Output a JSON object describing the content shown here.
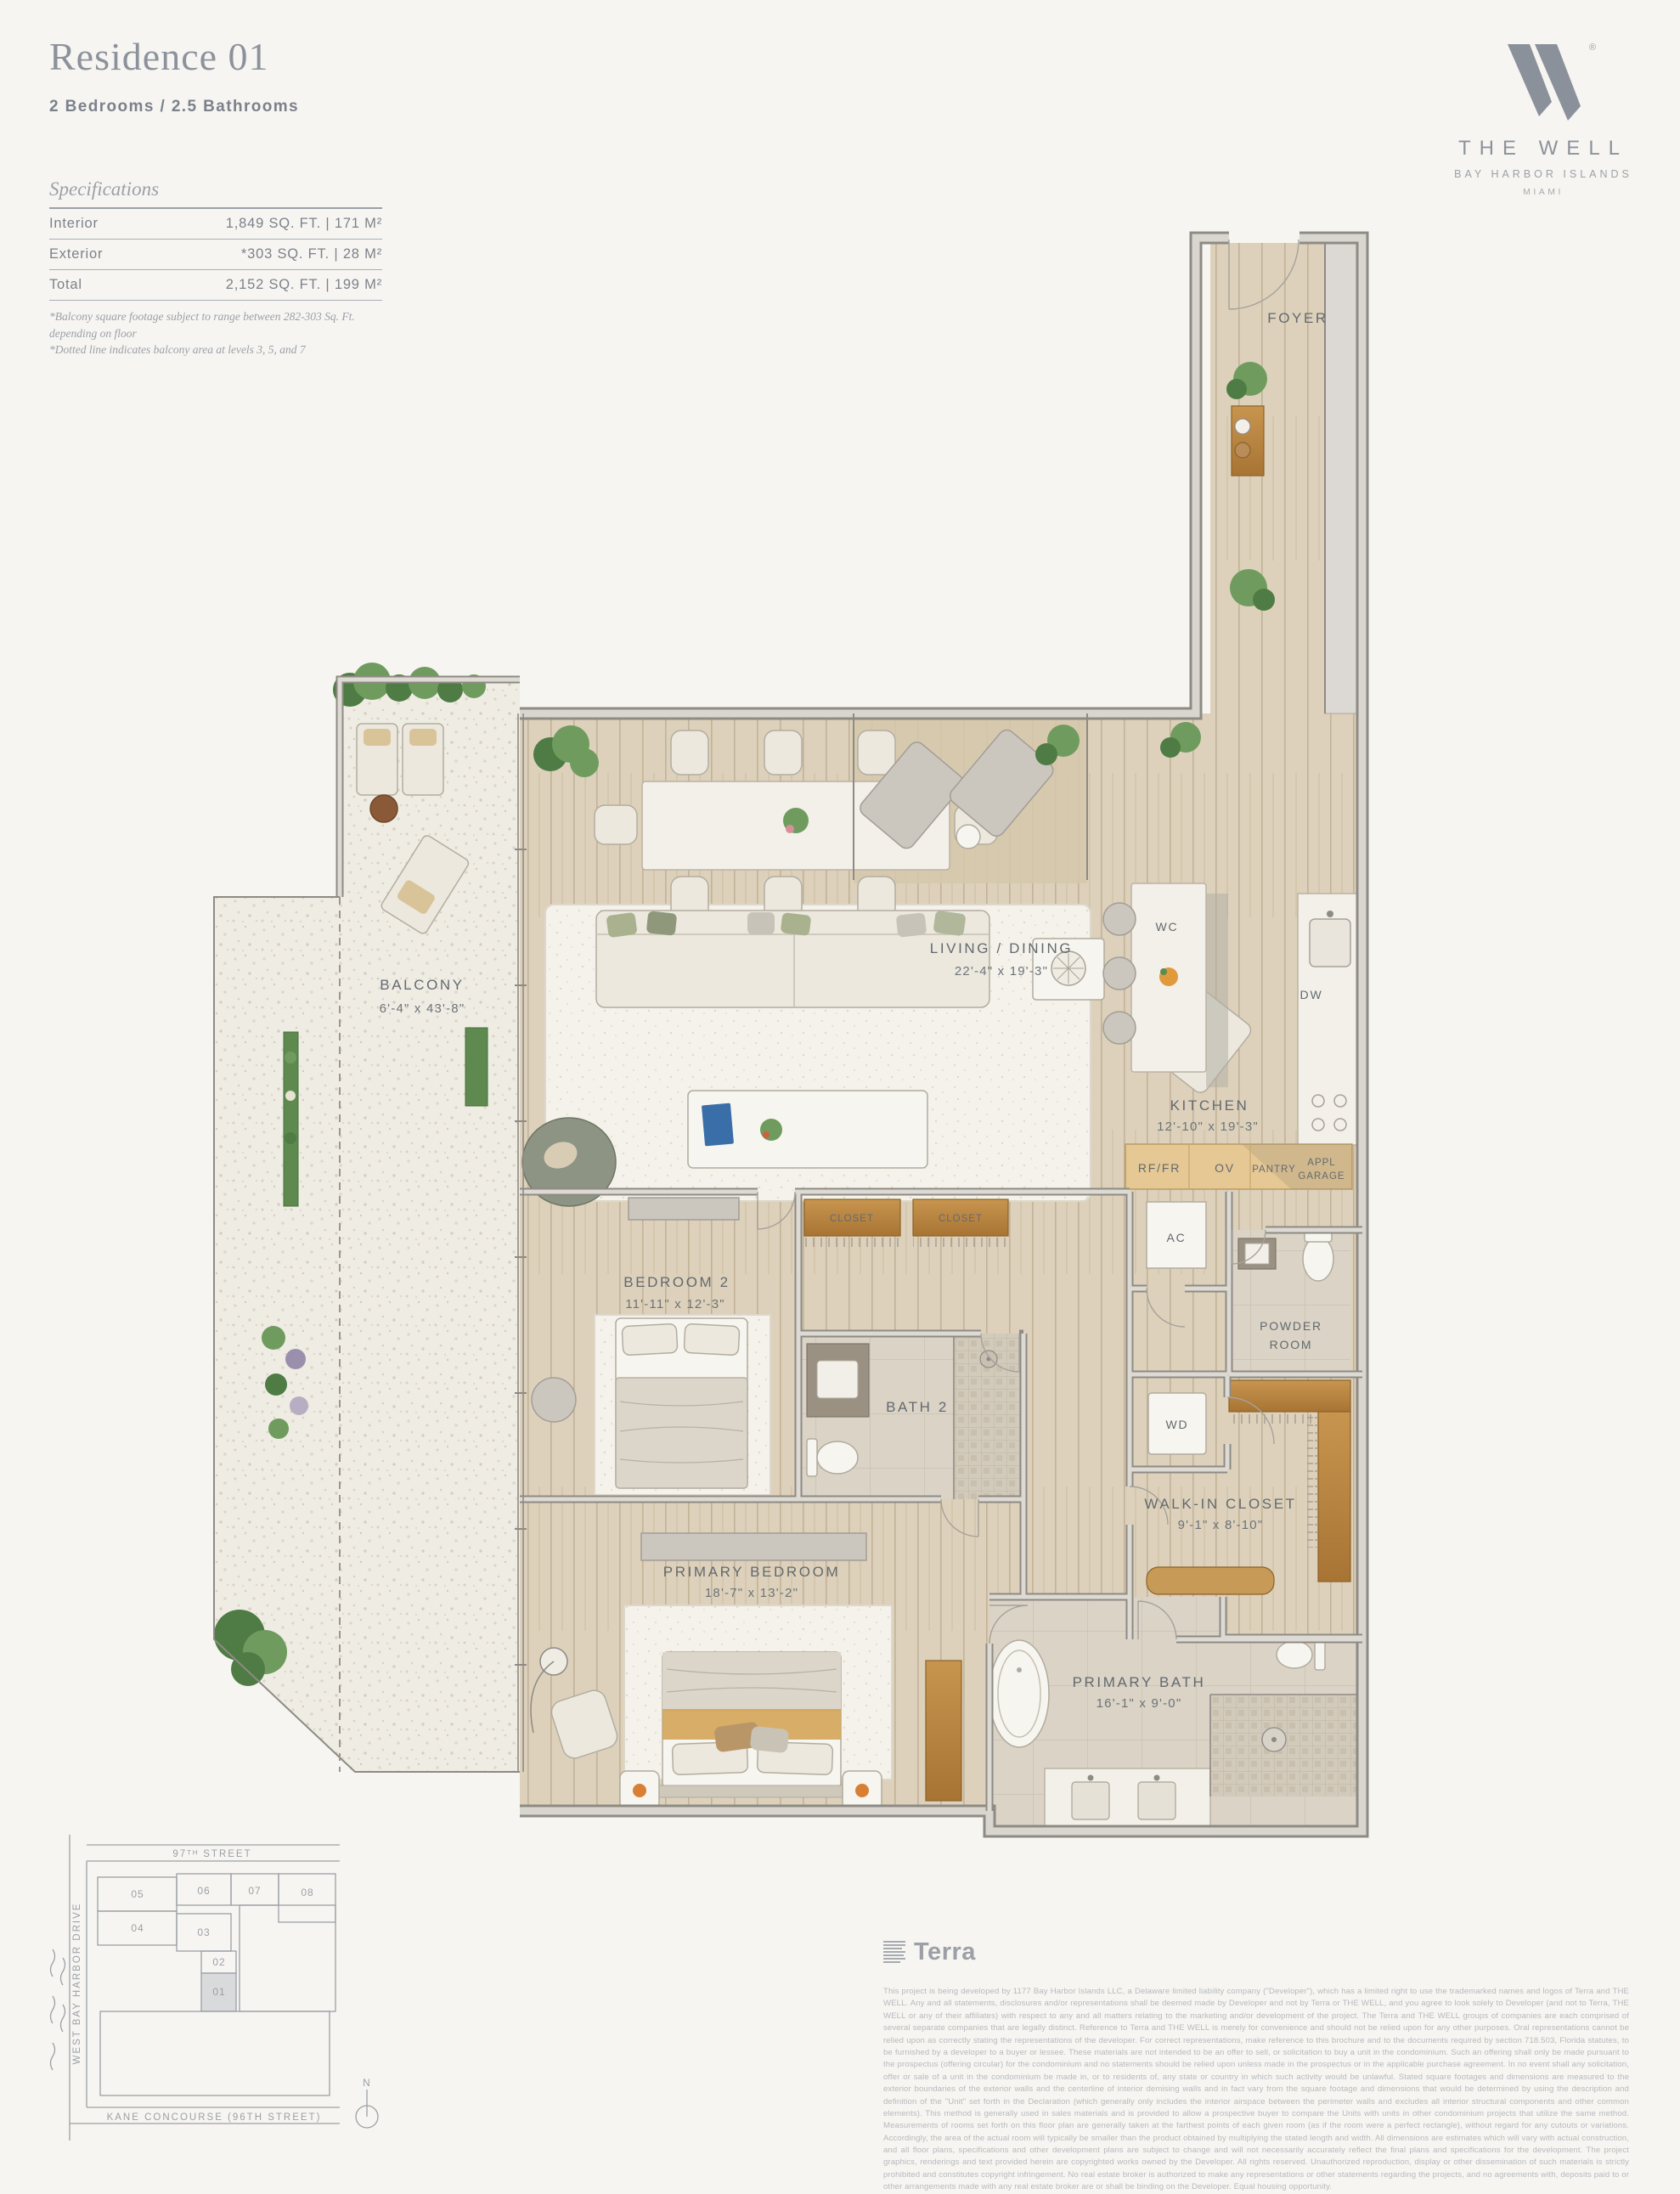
{
  "header": {
    "title": "Residence 01",
    "subtitle": "2 Bedrooms / 2.5 Bathrooms",
    "specs": {
      "heading": "Specifications",
      "rows": [
        {
          "label": "Interior",
          "value": "1,849 SQ. FT.  |  171 M²"
        },
        {
          "label": "Exterior",
          "value": "*303 SQ. FT.  |  28 M²"
        },
        {
          "label": "Total",
          "value": "2,152 SQ. FT.  |  199 M²"
        }
      ],
      "footnotes": [
        "*Balcony square footage subject to range between 282-303 Sq. Ft. depending on floor",
        "*Dotted line indicates balcony area at levels 3, 5, and 7"
      ]
    }
  },
  "brand": {
    "name": "THE WELL",
    "location": "BAY HARBOR ISLANDS",
    "city": "MIAMI",
    "registered": "®"
  },
  "plan": {
    "rooms": {
      "foyer": {
        "label": "FOYER"
      },
      "living": {
        "label": "LIVING / DINING",
        "dims": "22'-4\" x 19'-3\""
      },
      "balcony": {
        "label": "BALCONY",
        "dims": "6'-4\" x 43'-8\""
      },
      "wc": {
        "label": "WC"
      },
      "dw": {
        "label": "DW"
      },
      "kitchen": {
        "label": "KITCHEN",
        "dims": "12'-10\" x 19'-3\""
      },
      "rf_fr": {
        "label": "RF/FR"
      },
      "ov": {
        "label": "OV"
      },
      "pantry": {
        "label": "PANTRY"
      },
      "appl_garage": {
        "lines": [
          "APPL",
          "GARAGE"
        ]
      },
      "ac": {
        "label": "AC"
      },
      "powder": {
        "lines": [
          "POWDER",
          "ROOM"
        ]
      },
      "closet_a": {
        "label": "CLOSET"
      },
      "closet_b": {
        "label": "CLOSET"
      },
      "bedroom2": {
        "label": "BEDROOM 2",
        "dims": "11'-11\" x 12'-3\""
      },
      "bath2": {
        "label": "BATH 2"
      },
      "wd": {
        "label": "WD"
      },
      "walkin": {
        "label": "WALK-IN CLOSET",
        "dims": "9'-1\" x 8'-10\""
      },
      "primary_bedroom": {
        "label": "PRIMARY BEDROOM",
        "dims": "18'-7\" x 13'-2\""
      },
      "primary_bath": {
        "label": "PRIMARY BATH",
        "dims": "16'-1\" x 9'-0\""
      }
    }
  },
  "keymap": {
    "streets": {
      "top": "97ᵀᴴ STREET",
      "left": "WEST BAY HARBOR DRIVE",
      "bottom": "KANE CONCOURSE (96TH STREET)"
    },
    "units": [
      "05",
      "06",
      "07",
      "08",
      "04",
      "03",
      "02",
      "01"
    ],
    "highlighted_unit": "01",
    "compass": "N"
  },
  "footer": {
    "developer_logo": "Terra",
    "disclaimer": "This project is being developed by 1177 Bay Harbor Islands LLC, a Delaware limited liability company (\"Developer\"), which has a limited right to use the trademarked names and logos of Terra and THE WELL. Any and all statements, disclosures and/or representations shall be deemed made by Developer and not by Terra or THE WELL, and you agree to look solely to Developer (and not to Terra, THE WELL or any of their affiliates) with respect to any and all matters relating to the marketing and/or development of the project. The Terra and THE WELL groups of companies are each comprised of several separate companies that are legally distinct. Reference to Terra and THE WELL is merely for convenience and should not be relied upon for any other purposes. Oral representations cannot be relied upon as correctly stating the representations of the developer. For correct representations, make reference to this brochure and to the documents required by section 718.503, Florida statutes, to be furnished by a developer to a buyer or lessee. These materials are not intended to be an offer to sell, or solicitation to buy a unit in the condominium. Such an offering shall only be made pursuant to the prospectus (offering circular) for the condominium and no statements should be relied upon unless made in the prospectus or in the applicable purchase agreement. In no event shall any solicitation, offer or sale of a unit in the condominium be made in, or to residents of, any state or country in which such activity would be unlawful. Stated square footages and dimensions are measured to the exterior boundaries of the exterior walls and the centerline of interior demising walls and in fact vary from the square footage and dimensions that would be determined by using the description and definition of the \"Unit\" set forth in the Declaration (which generally only includes the interior airspace between the perimeter walls and excludes all interior structural components and other common elements). This method is generally used in sales materials and is provided to allow a prospective buyer to compare the Units with units in other condominium projects that utilize the same method. Measurements of rooms set forth on this floor plan are generally taken at the farthest points of each given room (as if the room were a perfect rectangle), without regard for any cutouts or variations. Accordingly, the area of the actual room will typically be smaller than the product obtained by multiplying the stated length and width. All dimensions are estimates which will vary with actual construction, and all floor plans, specifications and other development plans are subject to change and will not necessarily accurately reflect the final plans and specifications for the development. The project graphics, renderings and text provided herein are copyrighted works owned by the Developer. All rights reserved. Unauthorized reproduction, display or other dissemination of such materials is strictly prohibited and constitutes copyright infringement. No real estate broker is authorized to make any representations or other statements regarding the projects, and no agreements with, deposits paid to or other arrangements made with any real estate broker are or shall be binding on the Developer. Equal housing opportunity."
  }
}
